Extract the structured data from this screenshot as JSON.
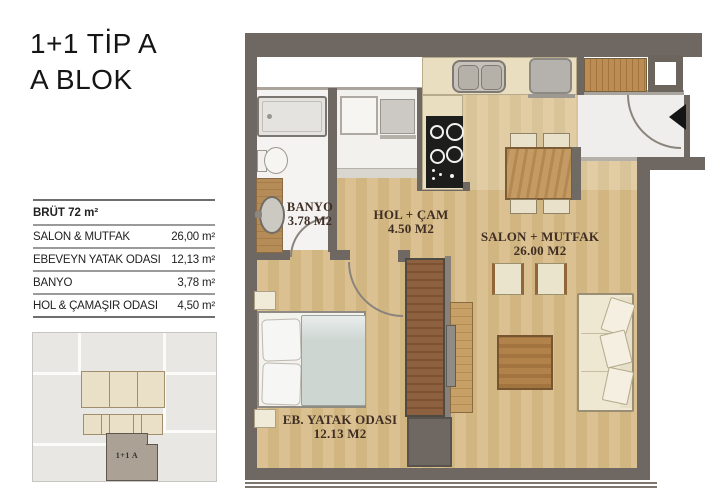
{
  "title": {
    "line1": "1+1 TİP A",
    "line2": "A BLOK"
  },
  "area_table": {
    "header": "BRÜT 72 m²",
    "rows": [
      {
        "label": "SALON & MUTFAK",
        "value": "26,00 m²"
      },
      {
        "label": "EBEVEYN YATAK ODASI",
        "value": "12,13 m²"
      },
      {
        "label": "BANYO",
        "value": "3,78 m²"
      },
      {
        "label": "HOL & ÇAMAŞIR ODASI",
        "value": "4,50 m²"
      }
    ]
  },
  "key_plan": {
    "unit_label": "1+1 A"
  },
  "floor_plan": {
    "rooms": [
      {
        "name": "BANYO",
        "area": "3.78 M2"
      },
      {
        "name": "HOL + ÇAM",
        "area": "4.50 M2"
      },
      {
        "name": "SALON + MUTFAK",
        "area": "26.00 M2"
      },
      {
        "name": "EB. YATAK ODASI",
        "area": "12.13 M2"
      }
    ],
    "colors": {
      "wall": "#6f6862",
      "wood_floor": "#d7bc8b",
      "counter": "#e9dfc0",
      "wardrobe": "#8d6140",
      "label_text": "#3f2e24",
      "highlighted_unit": "#aba295"
    }
  }
}
